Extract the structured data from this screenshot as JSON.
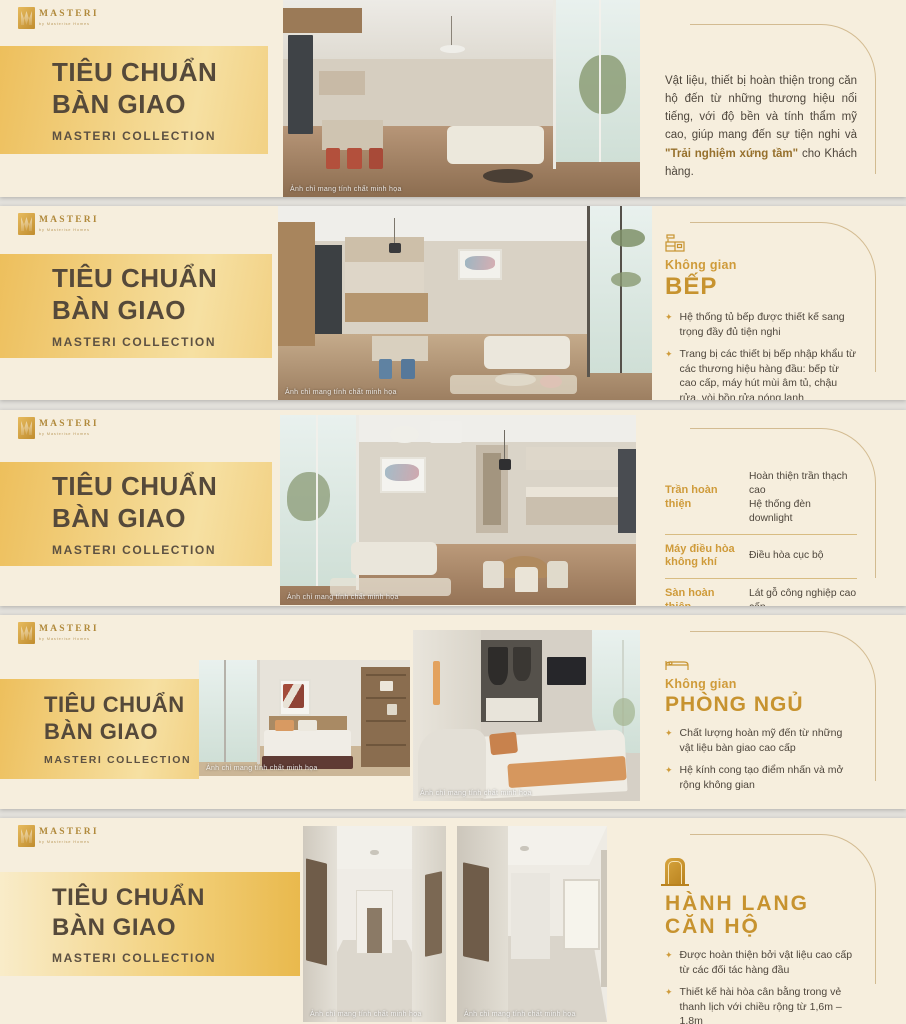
{
  "page": {
    "background": "#e2e0db"
  },
  "brand": {
    "name": "MASTERI",
    "tagline": "by Masterise Homes",
    "logo_icon": "masteri-m-monogram"
  },
  "colors": {
    "accent_gold": "#cf9b3a",
    "band_gold": "#edbf5c",
    "card_cream": "#f6eedd",
    "title_ink": "#55493a"
  },
  "common": {
    "title_line1": "TIÊU CHUẨN",
    "title_line2": "BÀN GIAO",
    "subtitle": "MASTERI COLLECTION",
    "photo_caption": "Ảnh chỉ mang tính chất minh họa",
    "bullet_glyph": "✦"
  },
  "slide1": {
    "paragraph": {
      "before": "Vật liệu, thiết bị hoàn thiện trong căn hộ đến từ những thương hiệu nổi tiếng, với độ bền và tính thẩm mỹ cao, giúp mang đến sự tiện nghi và ",
      "highlight": "\"Trải nghiệm xứng tầm\"",
      "after": " cho Khách hàng."
    }
  },
  "slide2": {
    "icon": "kitchen-icon",
    "eyebrow": "Không gian",
    "heading": "BẾP",
    "bullets": [
      "Hệ thống tủ bếp được thiết kế sang trọng đầy đủ tiện nghi",
      "Trang bị các thiết bị bếp nhập khẩu từ các thương hiệu hàng đầu: bếp từ cao cấp, máy hút mùi âm tủ, chậu rửa, vòi bồn rửa nóng lạnh",
      "Tường tủ bếp: vách bếp kính cường lực",
      "Mặt bếp được lát đá"
    ]
  },
  "slide3": {
    "spec_table": {
      "rows": [
        {
          "label": "Trần hoàn thiện",
          "value": "Hoàn thiện trần thạch cao\nHệ thống đèn downlight"
        },
        {
          "label": "Máy điều hòa\nkhông khí",
          "value": "Điều hòa cục bộ"
        },
        {
          "label": "Sàn hoàn thiện",
          "value": "Lát gỗ công nghiệp cao cấp"
        },
        {
          "label": "Ban công kính",
          "value": "Mở rộng không gian, tối đa tầm nhìn"
        }
      ]
    }
  },
  "slide4": {
    "icon": "bed-icon",
    "eyebrow": "Không gian",
    "heading": "PHÒNG NGỦ",
    "bullets": [
      "Chất lượng hoàn mỹ đến từ những vật liệu bàn giao cao cấp",
      "Hệ kính cong tạo điểm nhấn và mở rộng không gian"
    ]
  },
  "slide5": {
    "icon": "door-icon",
    "heading_line1": "HÀNH LANG",
    "heading_line2": "CĂN HỘ",
    "bullets": [
      "Được hoàn thiện bởi vật liệu cao cấp từ các đối tác hàng đầu",
      "Thiết kế hài hòa cân bằng trong vẻ thanh lịch với chiều rộng từ 1,6m – 1,8m",
      "Được trang bị điều hòa âm trần và hệ thống ánh sáng sang trọng"
    ]
  }
}
